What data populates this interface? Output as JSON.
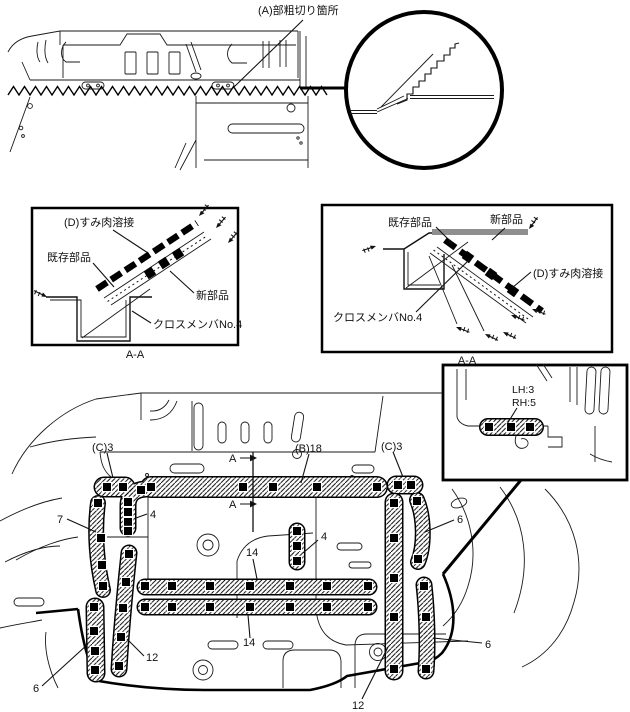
{
  "colors": {
    "ink": "#111111",
    "background": "#ffffff",
    "weld_square": "#000000",
    "new_part_gray": "#8f8f8f"
  },
  "top_view": {
    "cut_label": "(A)部粗切り箇所"
  },
  "detail_left": {
    "weld_label": "(D)すみ肉溶接",
    "existing_label": "既存部品",
    "new_label": "新部品",
    "member_label": "クロスメンバNo.4",
    "section_label": "A-A"
  },
  "detail_right": {
    "existing_label": "既存部品",
    "new_label": "新部品",
    "weld_label": "(D)すみ肉溶接",
    "member_label": "クロスメンバNo.4",
    "section_label": "A-A"
  },
  "floor_view": {
    "section_marker_top": "A",
    "section_marker_bottom": "A",
    "count_c3_left": "(C)3",
    "count_b18": "(B)18",
    "count_c3_right": "(C)3",
    "callout_7": "7",
    "callout_4_left": "4",
    "callout_4_middle": "4",
    "callout_14_upper": "14",
    "callout_14_lower": "14",
    "callout_12_left": "12",
    "callout_12_right": "12",
    "callout_6_bottom_left": "6",
    "callout_6_right_upper": "6",
    "callout_6_right_lower": "6",
    "inset": {
      "lh_count": "LH:3",
      "rh_count": "RH:5"
    }
  }
}
